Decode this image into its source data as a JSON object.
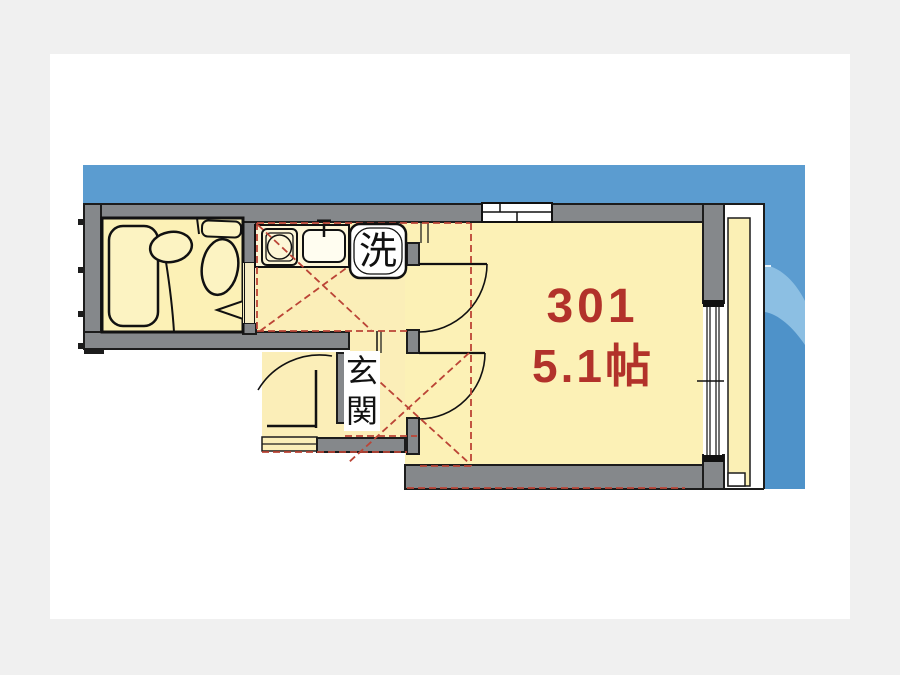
{
  "floor_plan": {
    "room_number": "301",
    "room_size_label": "5.1帖",
    "laundry_label": "洗",
    "entrance_label": "玄関",
    "colors": {
      "page_background": "#f0f0f0",
      "card_white": "#ffffff",
      "backdrop_blue_top": "#5b9cd0",
      "backdrop_blue_light_band": "#8cbfe3",
      "backdrop_blue_deep": "#4e92c9",
      "wall_gray": "#85888b",
      "floor_yellow": "#fcf1b6",
      "floor_yellow_warm": "#fbeeb8",
      "counter_cream": "#fdf6d6",
      "outline_black": "#1c1c1c",
      "renovation_dash_red": "#bb4436",
      "room_text_red": "#b2322a"
    }
  }
}
